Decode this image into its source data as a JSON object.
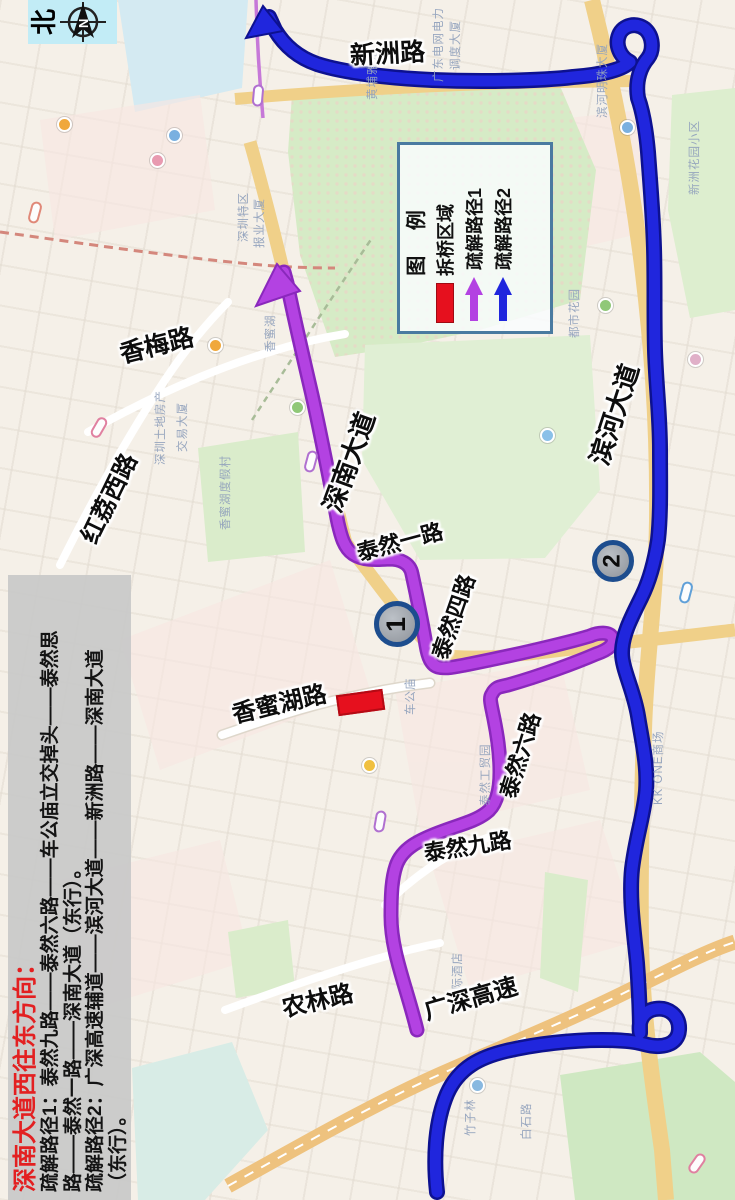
{
  "compass": {
    "label": "北",
    "letter": "N"
  },
  "legend": {
    "title": "图 例",
    "items": [
      {
        "label": "拆桥区域",
        "type": "rect"
      },
      {
        "label": "疏解路径1",
        "type": "arrow"
      },
      {
        "label": "疏解路径2",
        "type": "arrow"
      }
    ]
  },
  "description": {
    "title": "深南大道西往东方向：",
    "lines": [
      "疏解路径1：泰然九路——泰然六路——车公庙立交掉头——泰然思",
      "路——泰然一路——深南大道（东行）。",
      "疏解路径2：广深高速辅道——滨河大道——新洲路——深南大道",
      "（东行）。"
    ]
  },
  "badges": {
    "one": "1",
    "two": "2"
  },
  "colors": {
    "route1": "#b342e2",
    "route1_edge": "#8a28bc",
    "route2": "#2026dd",
    "route2_edge": "#0d1190",
    "demolition": "#e6101e",
    "legend_border": "#4a7aa0",
    "compass_bg": "#c2ecf6"
  },
  "road_labels": [
    {
      "text": "新洲路",
      "x": 350,
      "y": 48,
      "rot": -3,
      "size": 25
    },
    {
      "text": "香梅路",
      "x": 120,
      "y": 347,
      "rot": -14,
      "size": 25
    },
    {
      "text": "红荔西路",
      "x": 86,
      "y": 535,
      "rot": -64,
      "size": 24
    },
    {
      "text": "深南大道",
      "x": 330,
      "y": 505,
      "rot": -70,
      "size": 26
    },
    {
      "text": "泰然一路",
      "x": 357,
      "y": 547,
      "rot": -15,
      "size": 22
    },
    {
      "text": "泰然四路",
      "x": 438,
      "y": 653,
      "rot": -71,
      "size": 22
    },
    {
      "text": "滨河大道",
      "x": 597,
      "y": 458,
      "rot": -72,
      "size": 26
    },
    {
      "text": "泰然六路",
      "x": 506,
      "y": 792,
      "rot": -73,
      "size": 22
    },
    {
      "text": "泰然九路",
      "x": 424,
      "y": 847,
      "rot": -9,
      "size": 22
    },
    {
      "text": "香蜜湖路",
      "x": 232,
      "y": 707,
      "rot": -13,
      "size": 24
    },
    {
      "text": "农林路",
      "x": 282,
      "y": 1001,
      "rot": -13,
      "size": 24
    },
    {
      "text": "广深高速",
      "x": 424,
      "y": 1004,
      "rot": -16,
      "size": 24
    }
  ],
  "map_labels": [
    {
      "text": "新洲花园小区",
      "x": 686,
      "y": 195
    },
    {
      "text": "滨河明珠大厦",
      "x": 594,
      "y": 118
    },
    {
      "text": "都市花园",
      "x": 566,
      "y": 338
    },
    {
      "text": "KK ONE商场",
      "x": 650,
      "y": 805
    },
    {
      "text": "香蜜湖度假村",
      "x": 217,
      "y": 530
    },
    {
      "text": "深圳土地房产",
      "x": 152,
      "y": 465
    },
    {
      "text": "交易大厦",
      "x": 174,
      "y": 452
    },
    {
      "text": "车公庙",
      "x": 402,
      "y": 715
    },
    {
      "text": "竹子林",
      "x": 462,
      "y": 1136
    },
    {
      "text": "白石路",
      "x": 518,
      "y": 1140
    },
    {
      "text": "报业大厦",
      "x": 251,
      "y": 248
    },
    {
      "text": "深圳特区",
      "x": 235,
      "y": 242
    },
    {
      "text": "国际酒店",
      "x": 449,
      "y": 1002
    },
    {
      "text": "泰然工贸园",
      "x": 477,
      "y": 806
    },
    {
      "text": "黄埔雅苑",
      "x": 364,
      "y": 100
    },
    {
      "text": "广东电网电力",
      "x": 430,
      "y": 82
    },
    {
      "text": "调度大厦",
      "x": 447,
      "y": 70
    },
    {
      "text": "香蜜湖",
      "x": 262,
      "y": 352
    }
  ],
  "pois": [
    {
      "x": 57,
      "y": 117,
      "c": "#f0a83c"
    },
    {
      "x": 167,
      "y": 128,
      "c": "#7ab0e0"
    },
    {
      "x": 150,
      "y": 153,
      "c": "#e89ab0"
    },
    {
      "x": 208,
      "y": 338,
      "c": "#f0a83c"
    },
    {
      "x": 540,
      "y": 428,
      "c": "#8ac0e8"
    },
    {
      "x": 598,
      "y": 298,
      "c": "#90c878"
    },
    {
      "x": 362,
      "y": 758,
      "c": "#f0c040"
    },
    {
      "x": 620,
      "y": 120,
      "c": "#7ab0e0"
    },
    {
      "x": 688,
      "y": 352,
      "c": "#e0b0c8"
    },
    {
      "x": 470,
      "y": 1078,
      "c": "#88b8e0"
    },
    {
      "x": 290,
      "y": 400,
      "c": "#90c878"
    }
  ],
  "stations": [
    {
      "x": 247,
      "y": 90,
      "rot": -85,
      "c": "#b070d0"
    },
    {
      "x": 88,
      "y": 422,
      "rot": -60,
      "c": "#e080a0"
    },
    {
      "x": 369,
      "y": 816,
      "rot": -80,
      "c": "#b070d0"
    },
    {
      "x": 675,
      "y": 587,
      "rot": -75,
      "c": "#60a0d8"
    },
    {
      "x": 686,
      "y": 1158,
      "rot": -55,
      "c": "#e080a0"
    },
    {
      "x": 24,
      "y": 207,
      "rot": -75,
      "c": "#e08878"
    },
    {
      "x": 300,
      "y": 456,
      "rot": -75,
      "c": "#b070d0"
    }
  ]
}
